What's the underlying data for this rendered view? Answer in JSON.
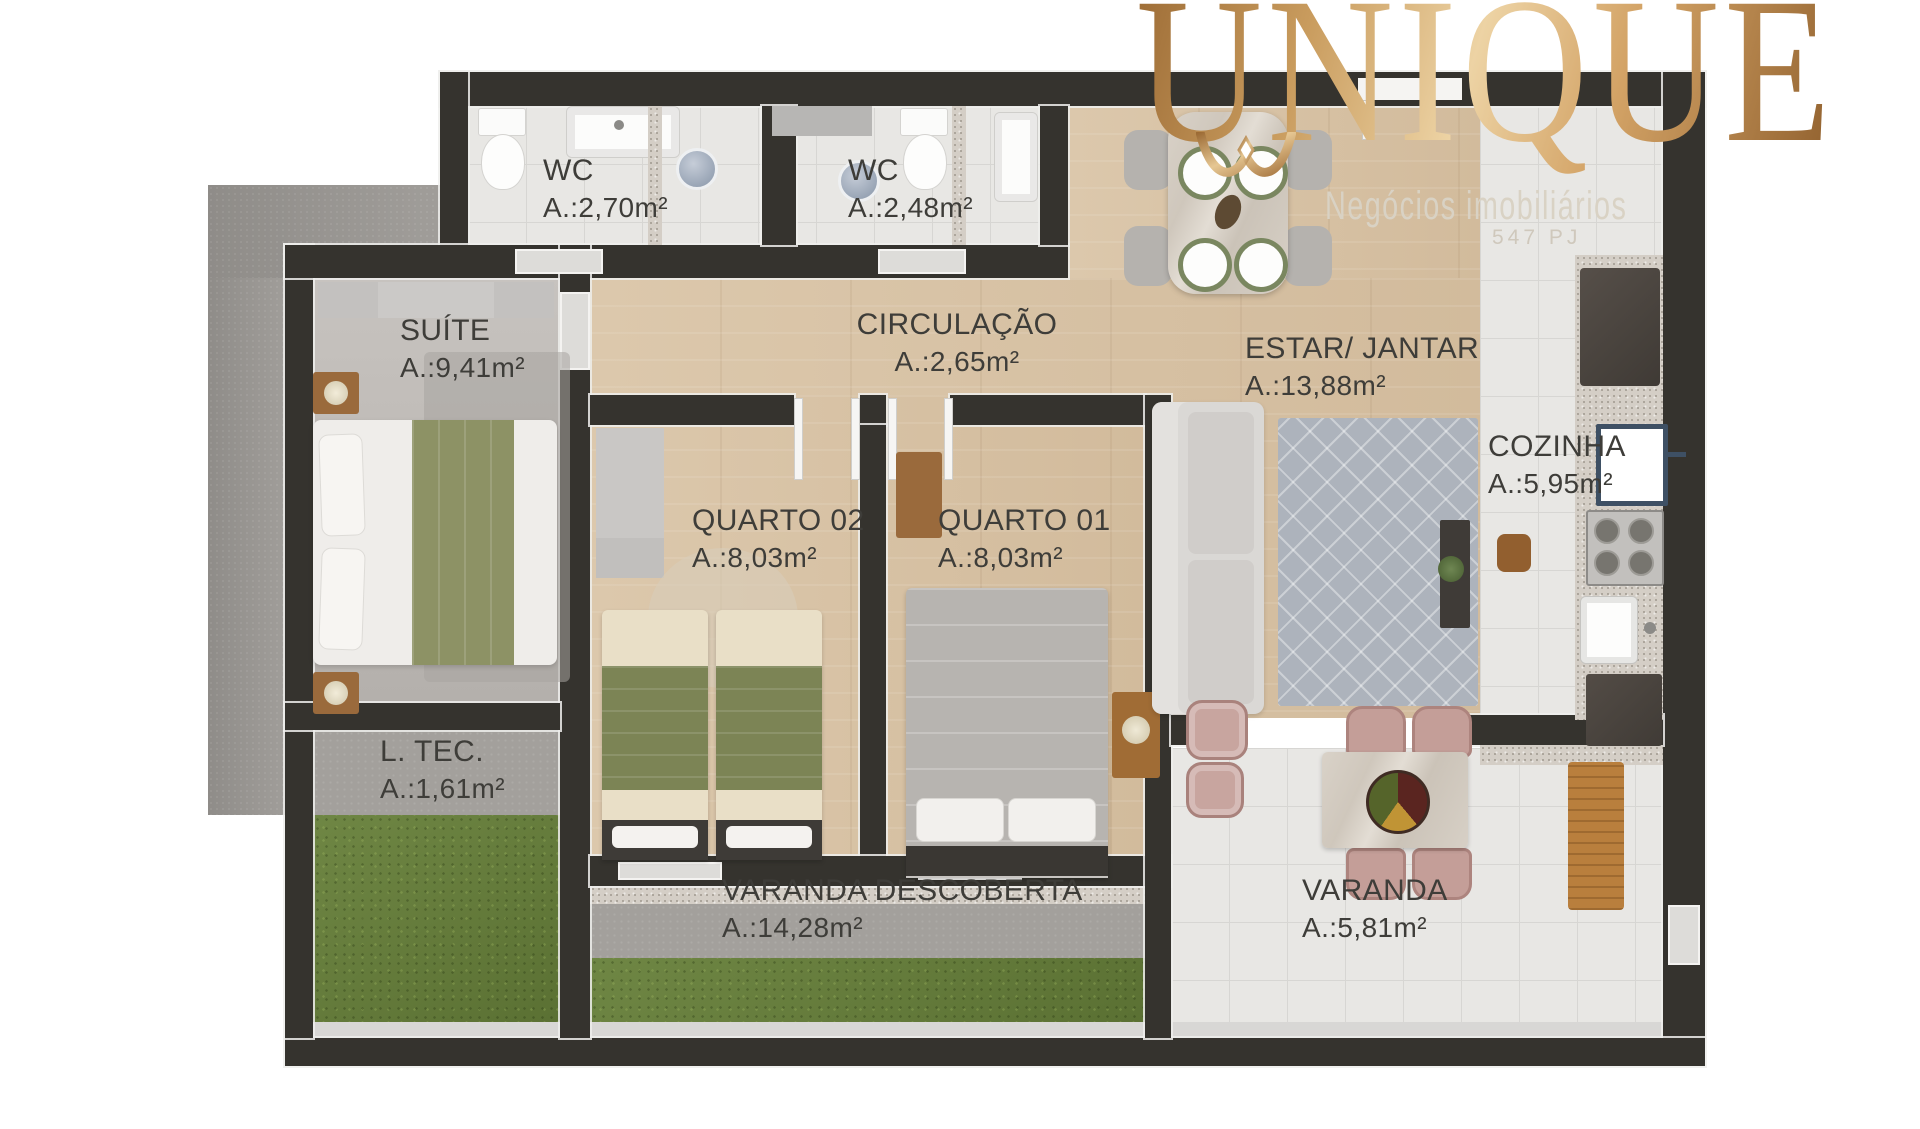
{
  "logo": {
    "brand": "UNIQUE",
    "subtitle": "Negócios imobiliários",
    "registration": "547 PJ"
  },
  "rooms": [
    {
      "id": "wc1",
      "label": "WC",
      "area": "A.:2,70m²"
    },
    {
      "id": "wc2",
      "label": "WC",
      "area": "A.:2,48m²"
    },
    {
      "id": "circulacao",
      "label": "CIRCULAÇÃO",
      "area": "A.:2,65m²"
    },
    {
      "id": "estar_jantar",
      "label": "ESTAR/ JANTAR",
      "area": "A.:13,88m²"
    },
    {
      "id": "suite",
      "label": "SUÍTE",
      "area": "A.:9,41m²"
    },
    {
      "id": "cozinha",
      "label": "COZINHA",
      "area": "A.:5,95m²"
    },
    {
      "id": "quarto02",
      "label": "QUARTO 02",
      "area": "A.:8,03m²"
    },
    {
      "id": "quarto01",
      "label": "QUARTO 01",
      "area": "A.:8,03m²"
    },
    {
      "id": "ltec",
      "label": "L. TEC.",
      "area": "A.:1,61m²"
    },
    {
      "id": "varanda_descoberta",
      "label": "VARANDA DESCOBERTA",
      "area": "A.:14,28m²"
    },
    {
      "id": "varanda",
      "label": "VARANDA",
      "area": "A.:5,81m²"
    }
  ],
  "colors": {
    "gold": "#c99c5e",
    "label_text": "#3e3d39",
    "wall": "#35332e",
    "wood_floor": "#d8c3a6",
    "tile_floor": "#e8e7e4",
    "grass": "#67803a",
    "concrete": "#a3a09c"
  }
}
